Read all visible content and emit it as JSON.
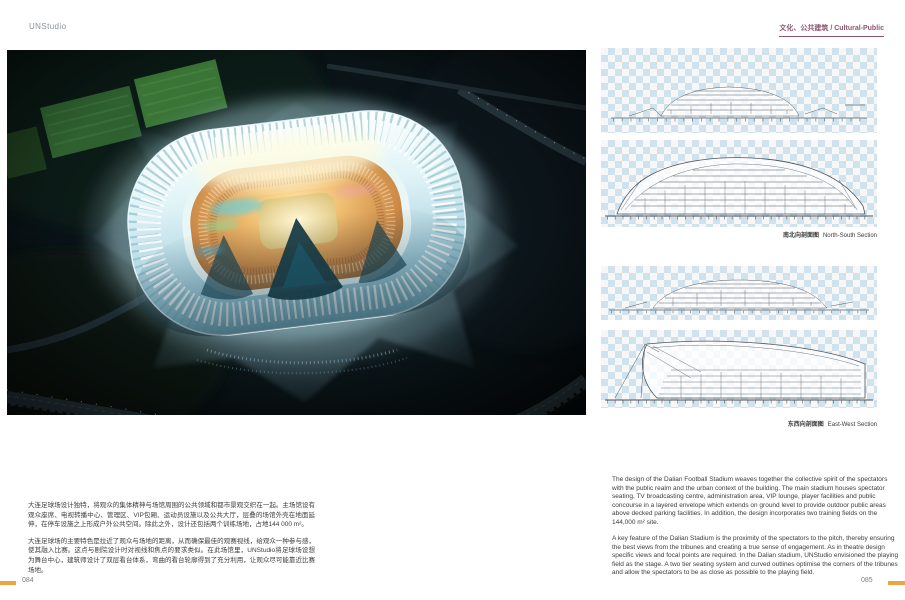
{
  "colors": {
    "accent_orange": "#eda63f",
    "header_plum": "#8c5670",
    "checker_blue": "#cfe2ed",
    "photo_night": "#05090b",
    "stadium_glow": "#bfe9f2",
    "bowl_warm": "#f0bf72"
  },
  "header": {
    "brand": "UNStudio",
    "category": "文化、公共建筑 / Cultural-Public"
  },
  "sections": {
    "group1": {
      "caption_cn": "南北向剖面图",
      "caption_en": "North-South Section"
    },
    "group2": {
      "caption_cn": "东西向剖面图",
      "caption_en": "East-West Section"
    }
  },
  "body_cn": {
    "p1": "大连足球场设计独特，将观众的集体精神与场馆周围的公共领域和都市景观交织在一起。主场馆设有观众座席、电视转播中心、管理区、VIP包厢、运动员设施以及公共大厅，层叠的场馆外壳在地面延伸，在停车设施之上形成户外公共空间。除此之外，设计还包括两个训练场地，占地144 000 m²。",
    "p2": "大连足球场的主要特色是拉近了观众与场地的距离，从而确保最佳的观赛视线，给观众一种参与感，使其融入比赛。这点与剧院设计时对视线和焦点的要求类似。在此场馆里，UNStudio将足球场设想为舞台中心，建筑师设计了双层看台体系，弯曲的看台轮廓得到了充分利用，让观众尽可能靠近比赛场地。"
  },
  "body_en": {
    "p1": "The design of the Dalian Football Stadium weaves together the collective spirit of the spectators with the public realm and the urban context of the building. The main stadium houses spectator seating, TV broadcasting centre, administration area, VIP lounge, player facilities and public concourse in a layered envelope which extends on ground level to provide outdoor public areas above decked parking facilities. In addition, the design incorporates two training fields on the 144,000 m² site.",
    "p2": "A key feature of the Dalian Stadium is the proximity of the spectators to the pitch, thereby ensuring the best views from the tribunes and creating a true sense of engagement. As in theatre design specific views and focal points are required. In the Dalian stadium, UNStudio envisioned the playing field as the stage. A two tier seating system and curved outlines optimise the corners of the tribunes and allow the spectators to be as close as possible to the playing field."
  },
  "footer": {
    "left_page": "084",
    "right_page": "085"
  }
}
